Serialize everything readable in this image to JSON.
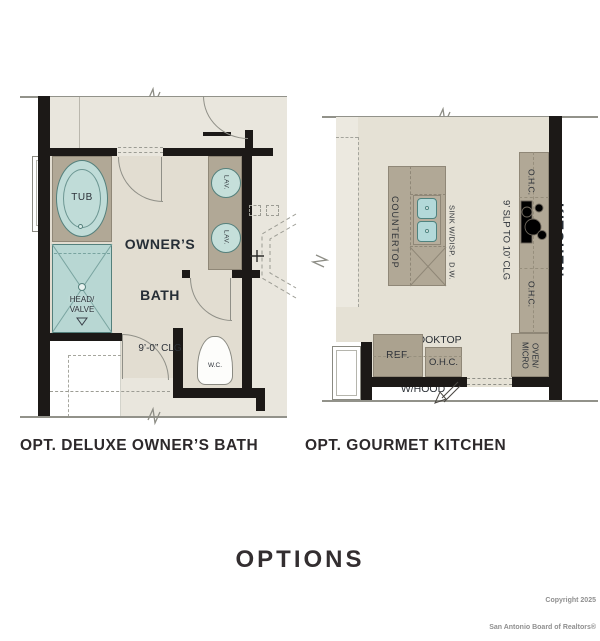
{
  "captions": {
    "bath": "OPT. DELUXE OWNER’S BATH",
    "kitchen": "OPT. GOURMET KITCHEN"
  },
  "footer": {
    "title": "OPTIONS",
    "copyright1": "Copyright 2025",
    "copyright2": "San Antonio Board of Realtors®"
  },
  "bath": {
    "name1": "OWNER’S",
    "name2": "BATH",
    "ceiling": "9’-0” CLG",
    "tub": "TUB",
    "lav_top": "LAV.",
    "lav_bottom": "LAV.",
    "shower1": "HEAD/",
    "shower2": "VALVE",
    "wc": "W.C."
  },
  "kitchen": {
    "name": "KITCHEN",
    "ceiling": "9’ SLP TO 10’ CLG",
    "countertop": "COUNTERTOP",
    "sink": "SINK W/DISP.  D.W.",
    "cooktop1": "GAS COOKTOP",
    "cooktop2": "W/HOOD",
    "ref": "REF.",
    "ohc_upper": "O.H.C.",
    "ohc_lower": "O.H.C.",
    "ohc_base": "O.H.C.",
    "oven1": "OVEN/",
    "oven2": "MICRO"
  },
  "colors": {
    "wall": "#1c1917",
    "bath_floor": "#e2ddd1",
    "hall_floor": "#e9e6dd",
    "kitchen_floor": "#e5e1d5",
    "counter": "#b1a896",
    "fixture_fill": "#bedcd8",
    "fixture_line": "#54807c",
    "plan_line": "#8f8f87",
    "label_text": "#2c3138",
    "caption_text": "#2d292b",
    "copyright_text": "#8f8f8f"
  }
}
